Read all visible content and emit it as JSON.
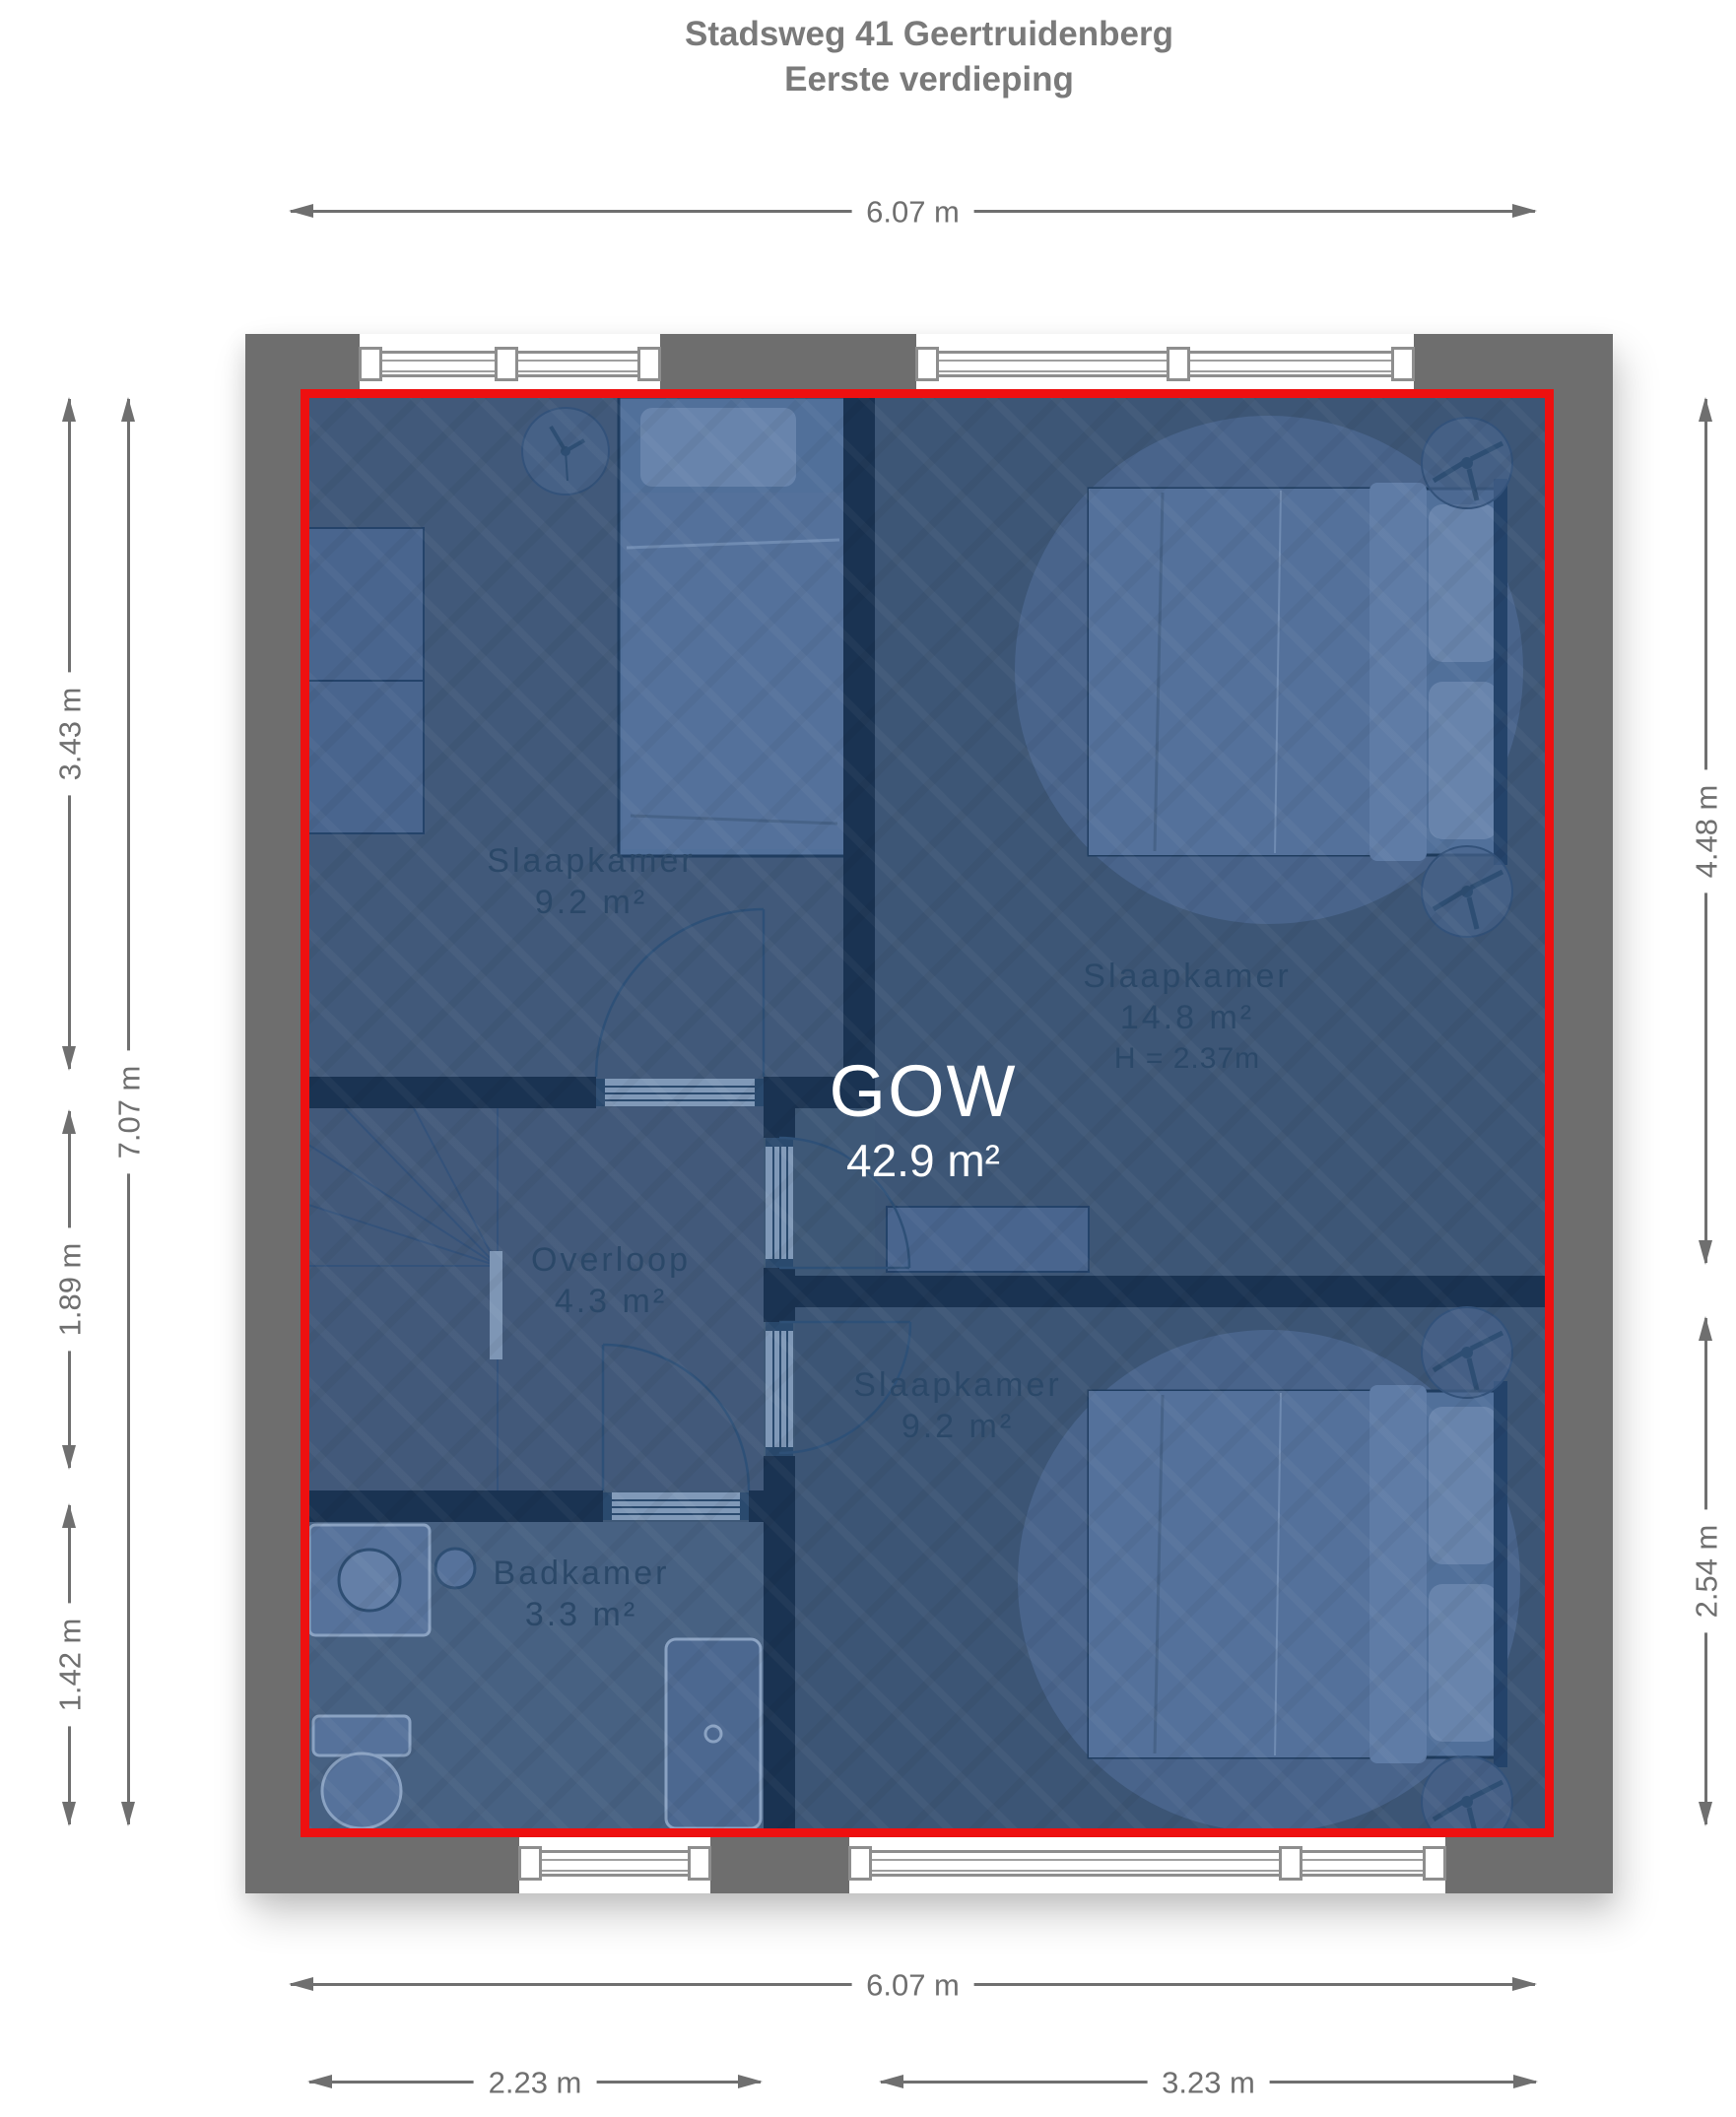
{
  "title": {
    "line1": "Stadsweg 41 Geertruidenberg",
    "line2": "Eerste verdieping"
  },
  "overlay": {
    "label": "GOW",
    "area": "42.9 m²"
  },
  "rooms": [
    {
      "name": "Slaapkamer",
      "area": "9.2 m²"
    },
    {
      "name": "Slaapkamer",
      "area": "14.8 m²",
      "ceiling_height": "H = 2.37m"
    },
    {
      "name": "Overloop",
      "area": "4.3 m²"
    },
    {
      "name": "Slaapkamer",
      "area": "9.2 m²"
    },
    {
      "name": "Badkamer",
      "area": "3.3 m²"
    }
  ],
  "dimensions": {
    "top_width": "6.07 m",
    "bottom_width": "6.07 m",
    "bottom_segment_left": "2.23 m",
    "bottom_segment_right": "3.23 m",
    "left_segment_top": "3.43 m",
    "left_segment_middle": "1.89 m",
    "left_segment_bottom": "1.42 m",
    "left_total_height": "7.07 m",
    "right_segment_top": "4.48 m",
    "right_segment_bottom": "2.54 m"
  },
  "colors": {
    "overlay_fill": "#3E5877",
    "overlay_border": "#EE1010",
    "wall_exterior": "#6E6E6E",
    "wall_interior": "#1A3352",
    "dimension_text": "#6F6F6F",
    "title_text": "#7A7A7A",
    "room_label_text": "#2B4868",
    "overlay_label_text": "#FFFFFF"
  }
}
